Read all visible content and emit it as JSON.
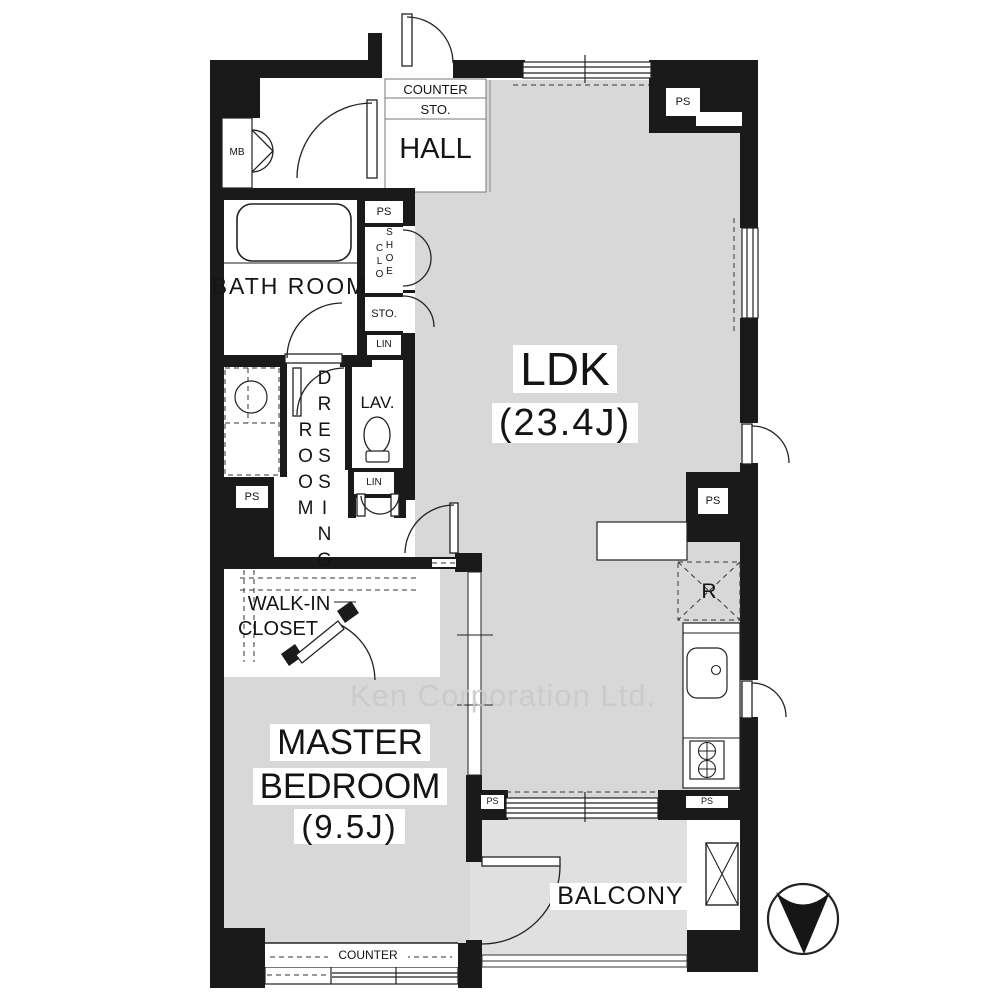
{
  "watermark": "Ken Corporation Ltd.",
  "labels": {
    "hall": "HALL",
    "hall_counter": "COUNTER",
    "hall_sto": "STO.",
    "bath_room": "BATH ROOM",
    "shoe_closet_left_col": "CLO",
    "shoe_closet_right_col": "SHOE",
    "sto_closet": "STO.",
    "lin_upper": "LIN",
    "lin_lower": "LIN",
    "dressing_left_col": "ROOM",
    "dressing_right_col": "DRESSING",
    "lav": "LAV.",
    "walk_in_line1": "WALK-IN",
    "walk_in_line2": "CLOSET",
    "master_line1": "MASTER",
    "master_line2": "BEDROOM",
    "master_size": "(9.5J)",
    "ldk_name": "LDK",
    "ldk_size": "(23.4J)",
    "balcony": "BALCONY",
    "bedroom_counter": "COUNTER",
    "refrigerator": "R",
    "meter_box": "MB",
    "ps": {
      "top_right": "PS",
      "bath_side": "PS",
      "dressing_side": "PS",
      "ldk_right": "PS",
      "ldk_bottom": "PS",
      "kitchen_bottom": "PS"
    }
  },
  "colors": {
    "wall": "#1a1a1a",
    "ldk_floor": "#d8d8d8",
    "balcony_floor": "#e0e0e0",
    "line": "#222222",
    "watermark": "#c9c9c9"
  }
}
